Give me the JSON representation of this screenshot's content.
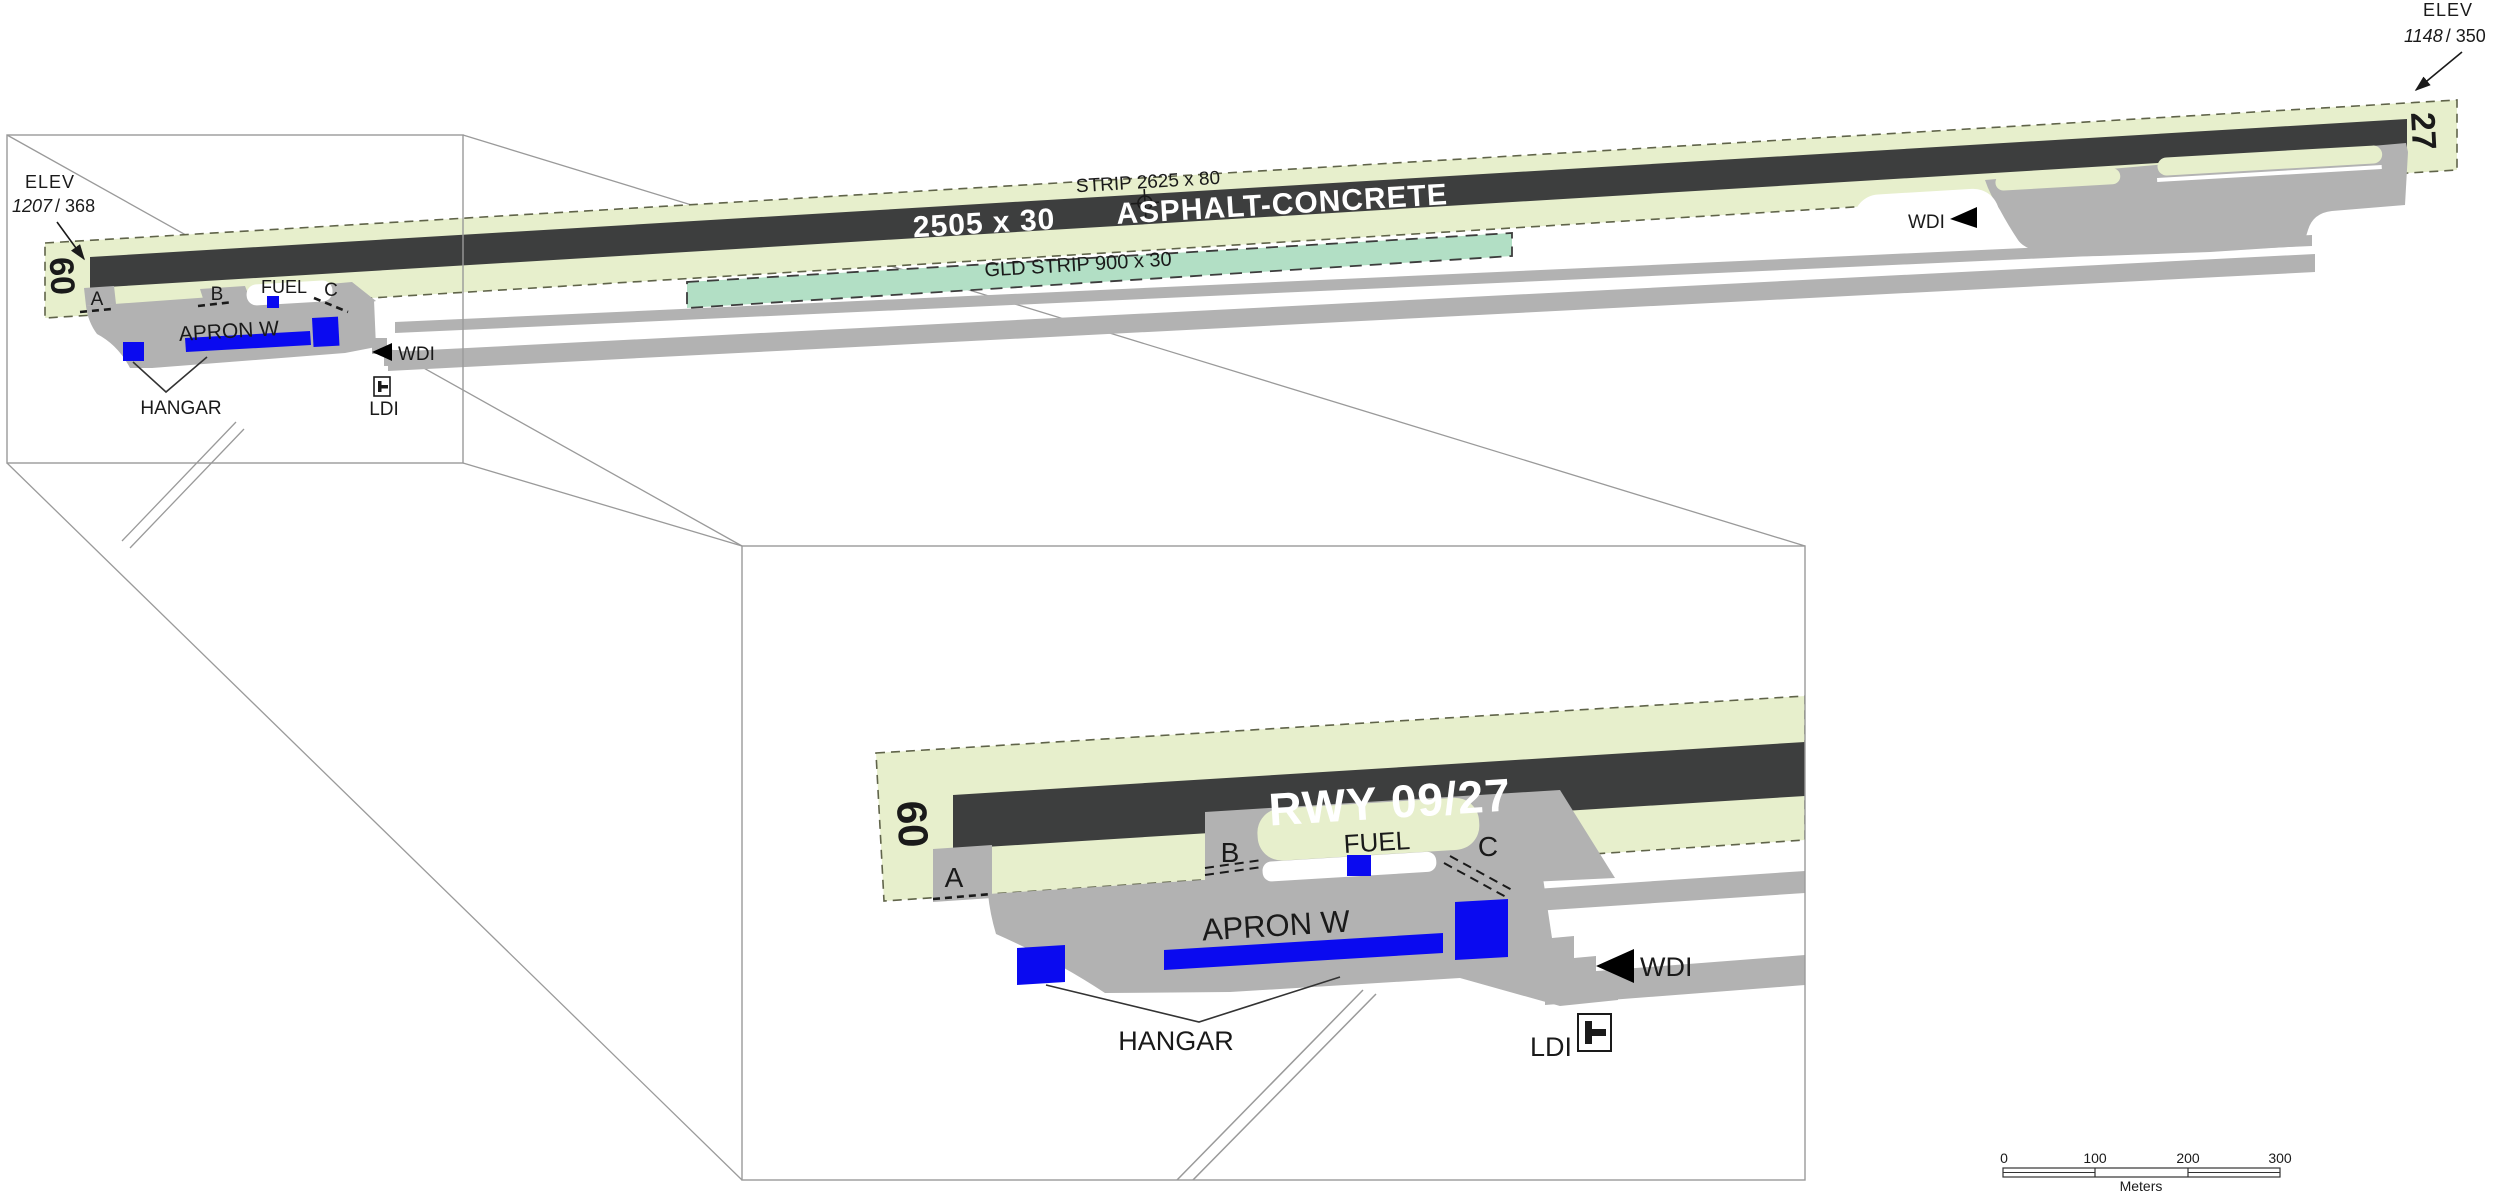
{
  "overview": {
    "elev_west": {
      "label": "ELEV",
      "elevation": "1207",
      "reference": "/ 368"
    },
    "elev_east": {
      "label": "ELEV",
      "elevation": "1148",
      "reference": "/ 350"
    },
    "rwy_designator_west": "09",
    "rwy_designator_east": "27",
    "runway_dimensions": "2505 x 30",
    "surface_label": "ASPHALT-CONCRETE",
    "strip_label": "STRIP  2625 x 80",
    "gld_strip_label": "GLD STRIP   900 x 30",
    "taxiway_a": "A",
    "taxiway_b": "B",
    "taxiway_c": "C",
    "fuel_label": "FUEL",
    "apron_label": "APRON W",
    "hangar_label": "HANGAR",
    "wdi_west_label": "WDI",
    "wdi_east_label": "WDI",
    "ldi_label": "LDI"
  },
  "inset": {
    "runway_label": "RWY 09/27",
    "rwy_designator_west": "09",
    "taxiway_a": "A",
    "taxiway_b": "B",
    "taxiway_c": "C",
    "fuel_label": "FUEL",
    "apron_label": "APRON W",
    "hangar_label": "HANGAR",
    "wdi_label": "WDI",
    "ldi_label": "LDI"
  },
  "scale_bar": {
    "ticks": [
      "0",
      "100",
      "200",
      "300"
    ],
    "unit_label": "Meters"
  },
  "colors": {
    "strip_green": "#e7efcc",
    "glider_strip": "#b2dfc5",
    "runway_asphalt": "#3d3e3e",
    "pavement": "#b2b2b2",
    "building": "#0a0af0",
    "callout_line": "#9a9a9a",
    "text": "#1a1a1a"
  }
}
